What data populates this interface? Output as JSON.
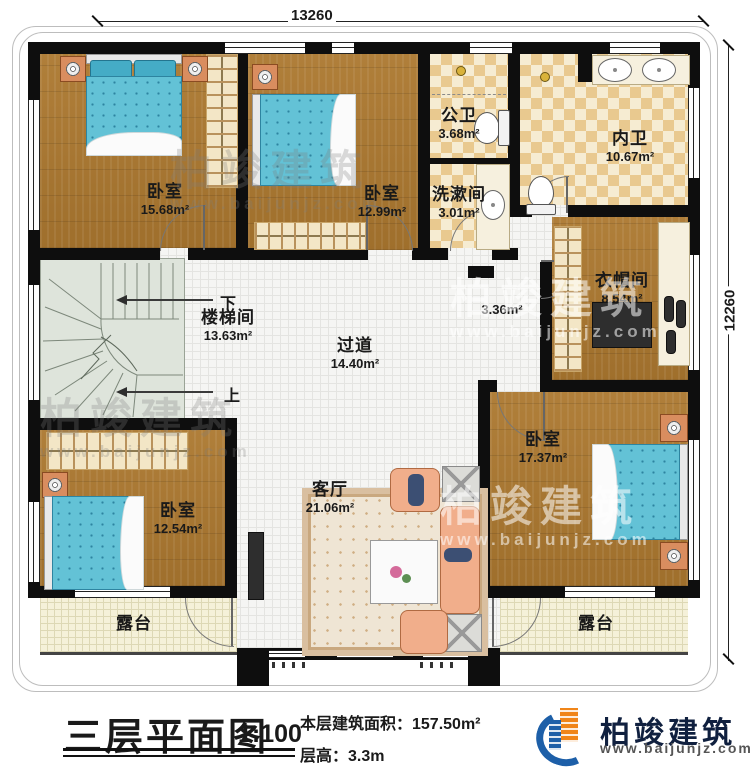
{
  "dimensions": {
    "top": "13260",
    "right": "12260"
  },
  "rooms": {
    "bedroom_nw": {
      "name": "卧室",
      "area": "15.68m²"
    },
    "bedroom_n": {
      "name": "卧室",
      "area": "12.99m²"
    },
    "public_bath": {
      "name": "公卫",
      "area": "3.68m²"
    },
    "washroom": {
      "name": "洗漱间",
      "area": "3.01m²"
    },
    "inner_bath": {
      "name": "内卫",
      "area": "10.67m²"
    },
    "cloakroom": {
      "name": "衣帽间",
      "area": "8.54m²"
    },
    "stairwell": {
      "name": "楼梯间",
      "area": "13.63m²"
    },
    "hallway": {
      "name": "过道",
      "area": "14.40m²"
    },
    "hall_nook": {
      "area": "3.36m²"
    },
    "bedroom_e": {
      "name": "卧室",
      "area": "17.37m²"
    },
    "bedroom_sw": {
      "name": "卧室",
      "area": "12.54m²"
    },
    "living": {
      "name": "客厅",
      "area": "21.06m²"
    },
    "terrace_left": {
      "name": "露台"
    },
    "terrace_right": {
      "name": "露台"
    }
  },
  "stairs": {
    "down": "下",
    "up": "上"
  },
  "watermark": {
    "text": "柏竣建筑",
    "url": "www.baijunjz.com"
  },
  "title_block": {
    "title": "三层平面图",
    "scale": "1:100",
    "area": "本层建筑面积：157.50m²",
    "floor_height": "层高：3.3m"
  },
  "brand": {
    "name": "柏竣建筑",
    "url": "www.baijunjz.com"
  },
  "colors": {
    "wall": "#0e0e0e",
    "wood": "#aa7933",
    "tile_tan": "#e9c98f",
    "bed_blue": "#63c2d6",
    "stair": "#dee4db",
    "terrace": "#f5f1d9",
    "brand_blue": "#1d5fa8",
    "brand_orange": "#f08519"
  }
}
